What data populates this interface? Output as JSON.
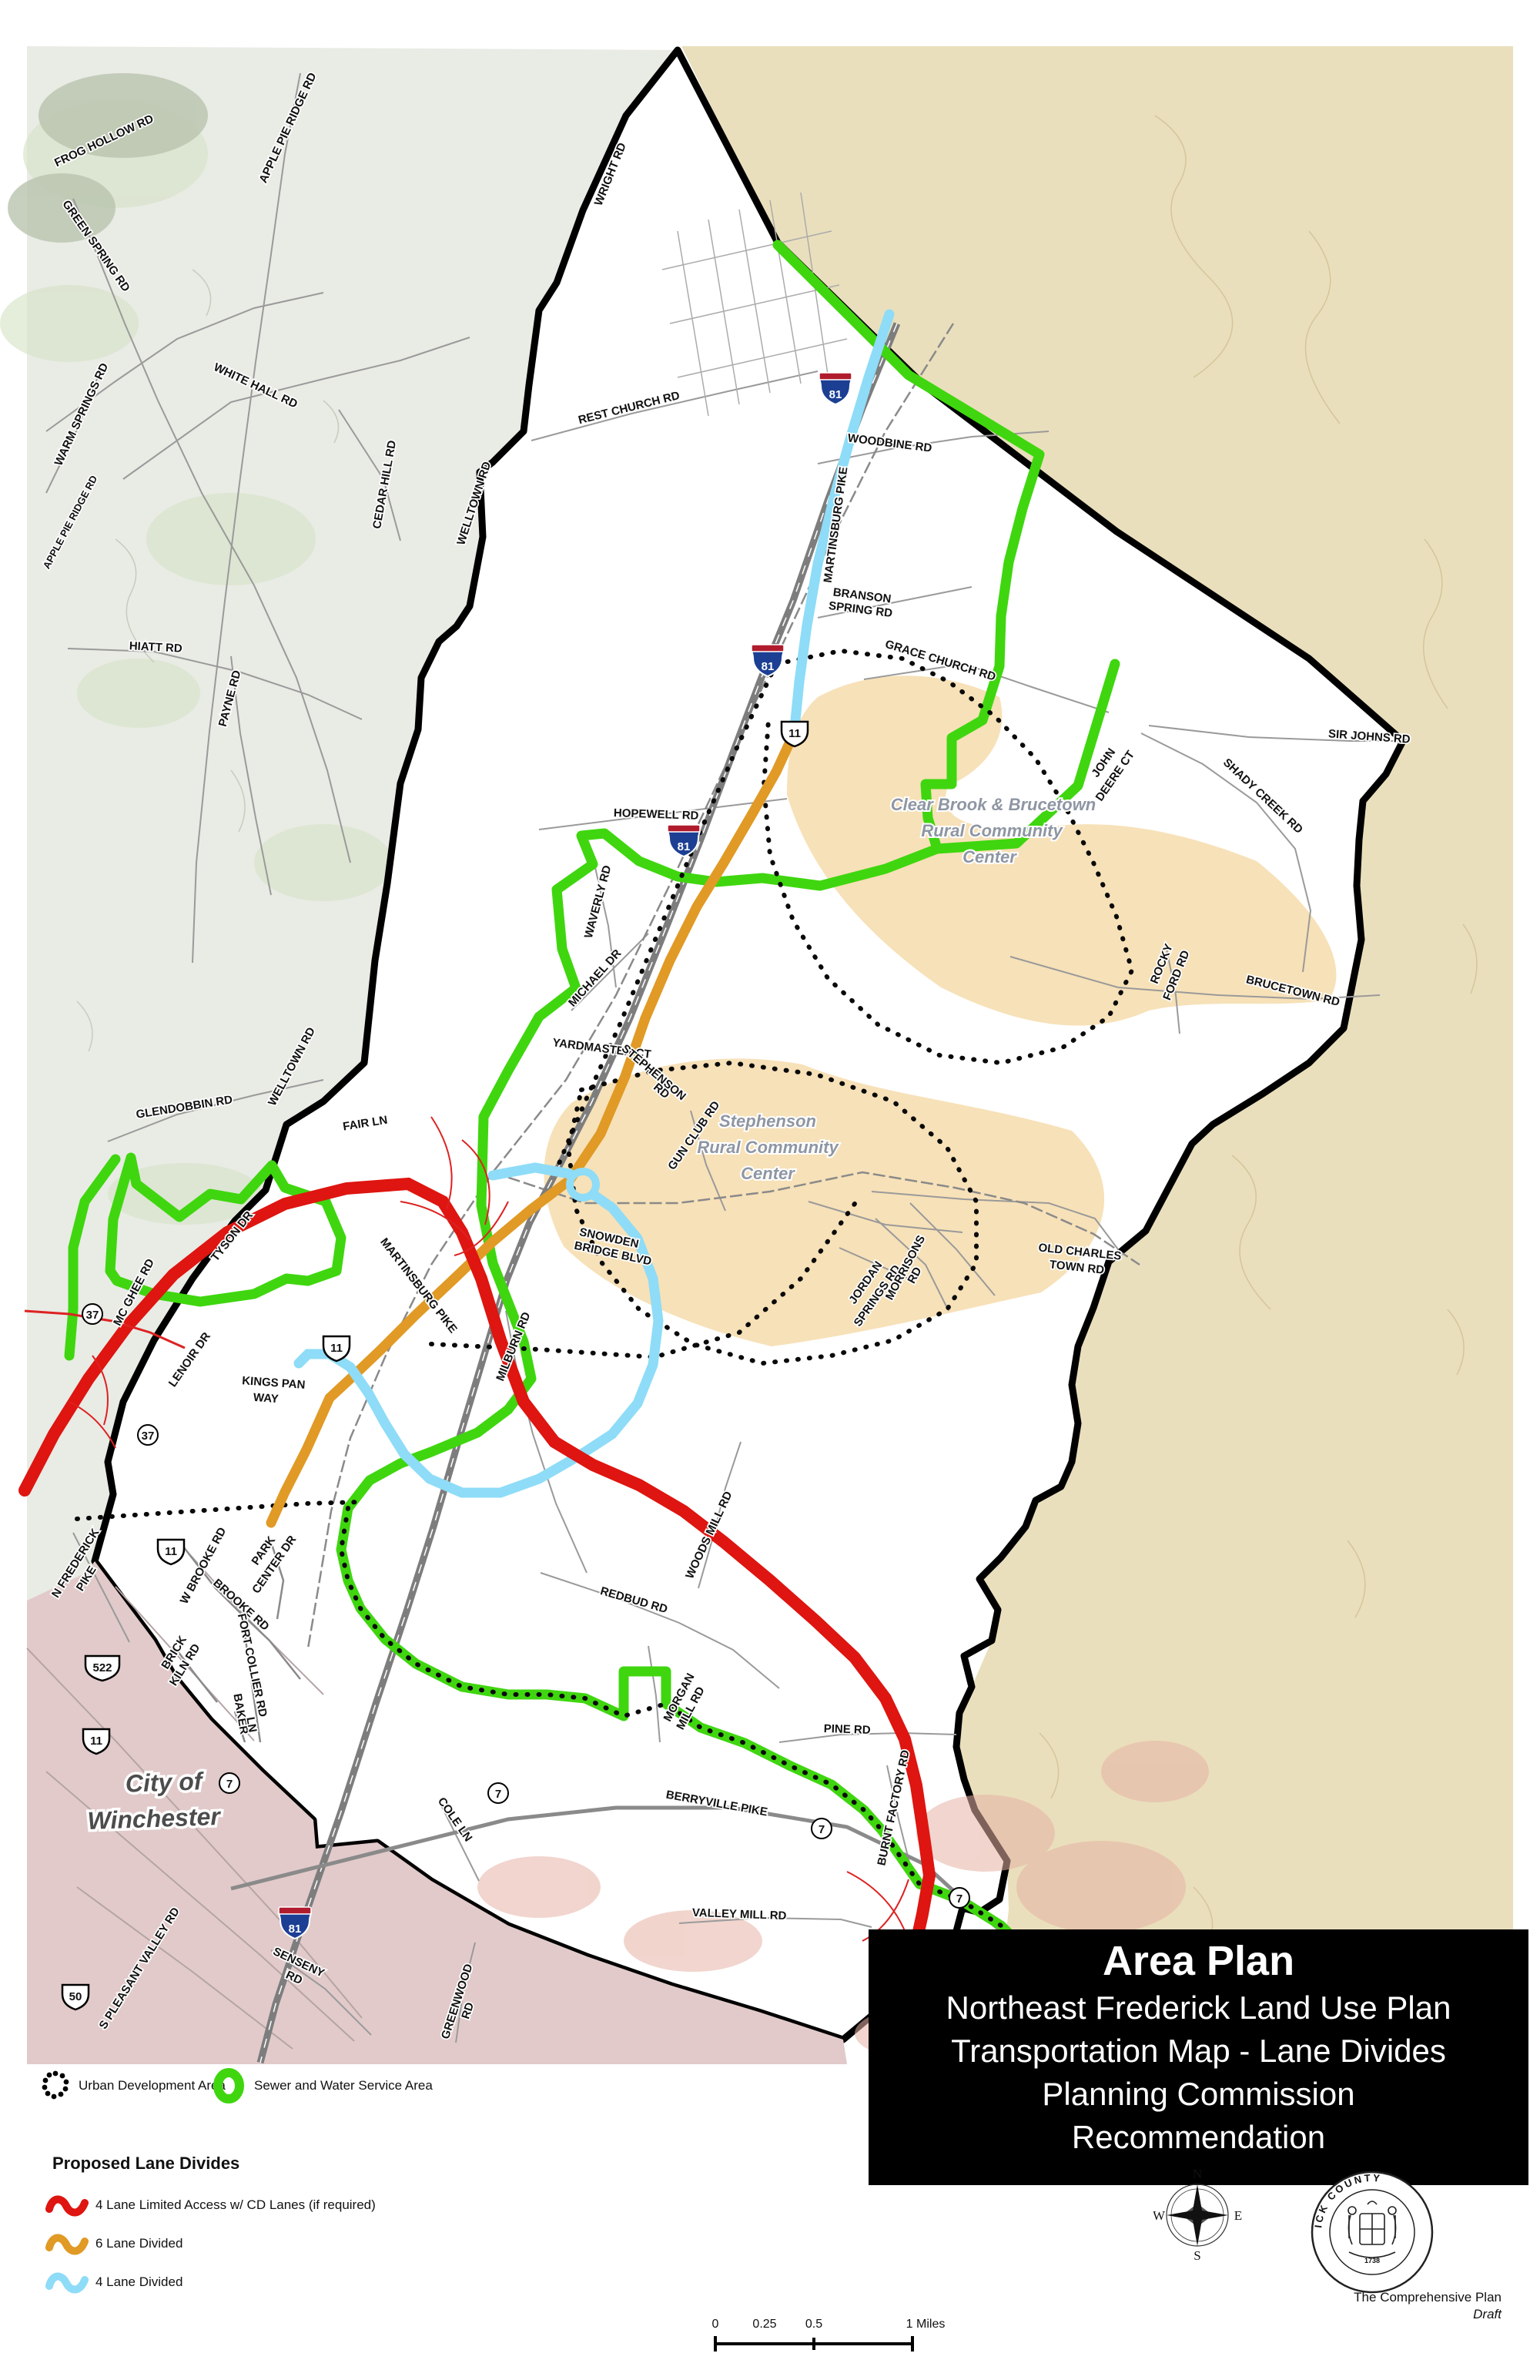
{
  "title_block": {
    "line1": "Area Plan",
    "line2": "Northeast Frederick Land Use Plan",
    "line3": "Transportation Map - Lane Divides",
    "line4": "Planning Commission",
    "line5": "Recommendation"
  },
  "legend": {
    "uda_label": "Urban Development Area",
    "sewer_label": "Sewer and Water Service Area",
    "proposed_heading": "Proposed Lane Divides",
    "items": [
      {
        "label": "4 Lane Limited Access w/ CD Lanes (if required)",
        "color": "#de1510"
      },
      {
        "label": "6 Lane Divided",
        "color": "#e09a25"
      },
      {
        "label": "4 Lane Divided",
        "color": "#8edcf7"
      }
    ]
  },
  "scale_bar": {
    "t0": "0",
    "t025": "0.25",
    "t05": "0.5",
    "t1": "1 Miles"
  },
  "compass": {
    "n": "N",
    "e": "E",
    "s": "S",
    "w": "W"
  },
  "seal": {
    "ring_text": "FREDERICK COUNTY",
    "year": "1738"
  },
  "credits": {
    "line1": "The Comprehensive Plan",
    "line2": "Draft"
  },
  "map": {
    "colors": {
      "sewer_green": "#3fd60f",
      "limited_access_red": "#de1510",
      "six_lane_orange": "#e09a25",
      "four_lane_blue": "#8edcf7",
      "rural_center_tan": "#f7e1b8"
    },
    "shields": {
      "i81": "81",
      "us11": "11",
      "us522": "522",
      "us50": "50",
      "r7": "7",
      "r37": "37"
    },
    "areas": {
      "city1": "City of",
      "city2": "Winchester",
      "cb1": "Clear Brook & Brucetown",
      "rc": "Rural Community",
      "center": "Center",
      "st1": "Stephenson"
    },
    "roads": {
      "frog_hollow": "FROG HOLLOW RD",
      "green_spring": "GREEN SPRING RD",
      "apple_pie": "APPLE PIE RIDGE RD",
      "warm_springs": "WARM SPRINGS RD",
      "white_hall": "WHITE HALL RD",
      "cedar_hill": "CEDAR HILL RD",
      "hiatt": "HIATT RD",
      "payne": "PAYNE RD",
      "welltown": "WELLTOWN RD",
      "wright": "WRIGHT RD",
      "rest_church": "REST CHURCH RD",
      "woodbine": "WOODBINE RD",
      "martinsburg": "MARTINSBURG PIKE",
      "branson1": "BRANSON",
      "branson2": "SPRING RD",
      "grace_church": "GRACE CHURCH RD",
      "sir_johns": "SIR JOHNS RD",
      "shady_creek": "SHADY CREEK RD",
      "john1": "JOHN",
      "john2": "DEERE CT",
      "hopewell": "HOPEWELL RD",
      "waverly": "WAVERLY RD",
      "michael": "MICHAEL DR",
      "rocky1": "ROCKY",
      "rocky2": "FORD RD",
      "brucetown": "BRUCETOWN RD",
      "yardmaster": "YARDMASTER CT",
      "stephenson1": "STEPHENSON",
      "rd": "RD",
      "gun_club": "GUN CLUB RD",
      "glendobbin": "GLENDOBBIN RD",
      "fair": "FAIR LN",
      "tyson": "TYSON DR",
      "mcghee": "MC GHEE RD",
      "lenoir": "LENOIR DR",
      "kings1": "KINGS PAN",
      "kings2": "WAY",
      "snowden1": "SNOWDEN",
      "snowden2": "BRIDGE BLVD",
      "milburn": "MILBURN RD",
      "oldcharles1": "OLD CHARLES",
      "oldcharles2": "TOWN RD",
      "jordan1": "JORDAN",
      "jordan2": "SPRINGS RD",
      "morrisons": "MORRISONS",
      "woods_mill": "WOODS MILL RD",
      "redbud": "REDBUD RD",
      "morgan1": "MORGAN",
      "morgan2": "MILL RD",
      "pine": "PINE RD",
      "burnt_factory": "BURNT FACTORY RD",
      "nfred1": "N FREDERICK",
      "nfred2": "PIKE",
      "wbrooke": "W BROOKE RD",
      "brooke": "BROOKE RD",
      "park1": "PARK",
      "park2": "CENTER DR",
      "brick1": "BRICK",
      "brick2": "KILN RD",
      "fort_collier": "FORT COLLIER RD",
      "baker1": "BAKER",
      "baker2": "LN",
      "cole": "COLE LN",
      "berryville": "BERRYVILLE PIKE",
      "valley_mill": "VALLEY MILL RD",
      "senseny": "SENSENY",
      "greenwood": "GREENWOOD",
      "pleasant": "S PLEASANT VALLEY RD"
    }
  }
}
